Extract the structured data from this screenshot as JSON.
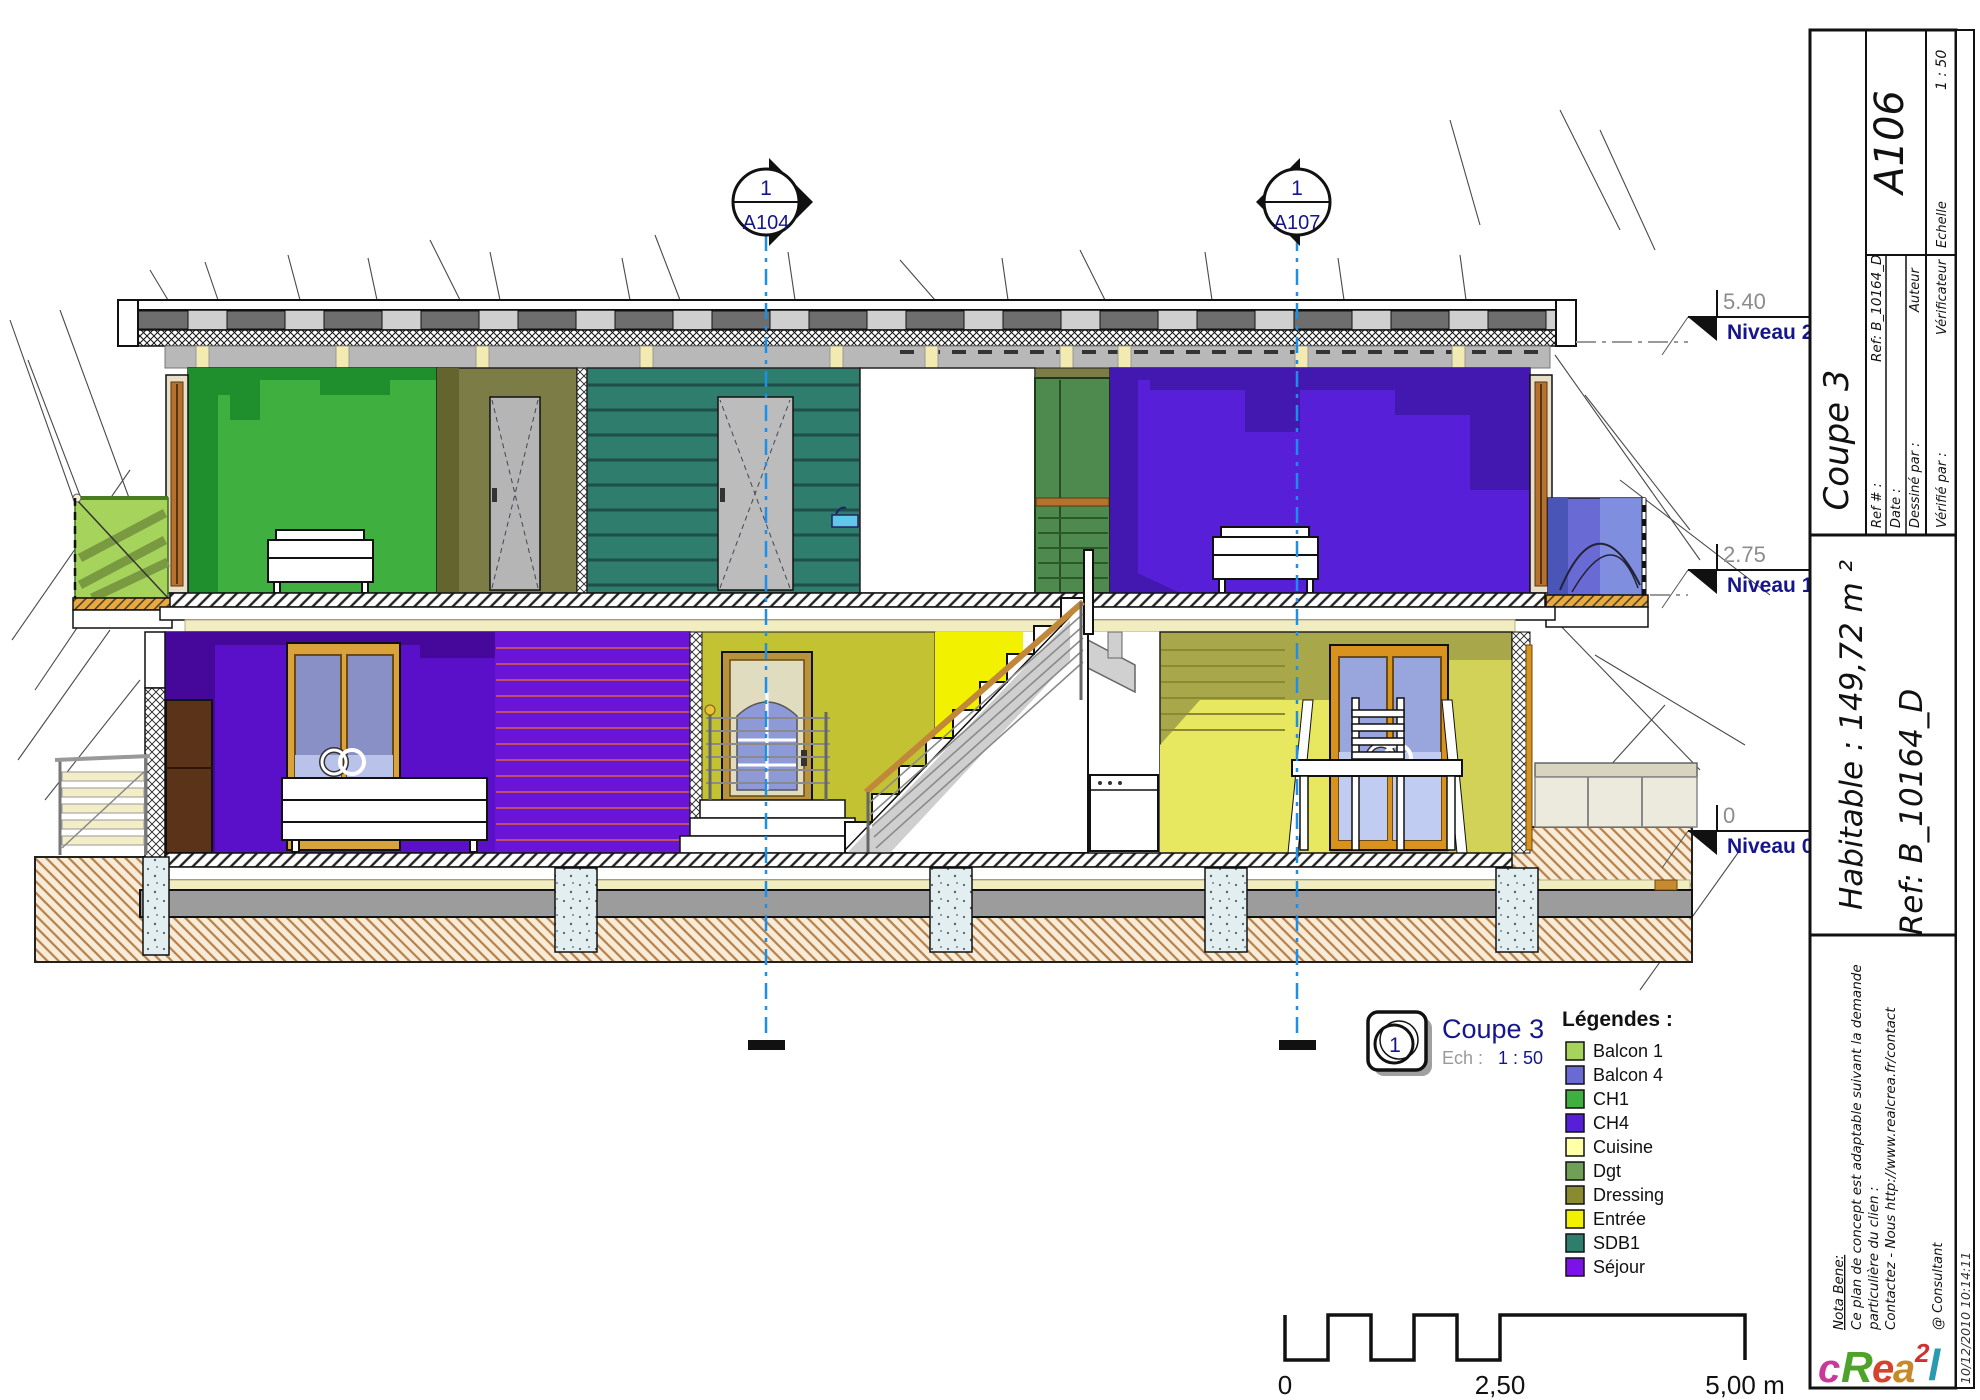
{
  "drawing": {
    "section_markers": [
      {
        "number": "1",
        "sheet": "A104"
      },
      {
        "number": "1",
        "sheet": "A107"
      }
    ],
    "levels": [
      {
        "elevation": "5.40",
        "name": "Niveau 2"
      },
      {
        "elevation": "2.75",
        "name": "Niveau 1"
      },
      {
        "elevation": "0",
        "name": "Niveau 0"
      }
    ],
    "view_label": {
      "number": "1",
      "title": "Coupe 3",
      "scale_prefix": "Ech :",
      "scale": "1 : 50"
    },
    "legend": {
      "title": "Légendes :",
      "items": [
        {
          "label": "Balcon 1",
          "color": "#a6d35c"
        },
        {
          "label": "Balcon 4",
          "color": "#6a6ad4"
        },
        {
          "label": "CH1",
          "color": "#3fb03f"
        },
        {
          "label": "CH4",
          "color": "#571fd8"
        },
        {
          "label": "Cuisine",
          "color": "#ffffa8"
        },
        {
          "label": "Dgt",
          "color": "#70a055"
        },
        {
          "label": "Dressing",
          "color": "#8a8a30"
        },
        {
          "label": "Entrée",
          "color": "#f2f200"
        },
        {
          "label": "SDB1",
          "color": "#2f7d6d"
        },
        {
          "label": "Séjour",
          "color": "#7d12e8"
        }
      ]
    },
    "scale_bar": {
      "start": "0",
      "middle": "2,50",
      "end": "5,00 m"
    }
  },
  "title_block": {
    "view_title": "Coupe 3",
    "sheet_number": "A106",
    "fields": {
      "ref_label": "Ref # :",
      "ref_value": "Ref: B_10164_D",
      "date_label": "Date :",
      "drawn_label": "Dessiné par :",
      "drawn_value": "Auteur",
      "checked_label": "Vérifié par :",
      "checked_value": "Vérificateur",
      "scale_label": "Echelle",
      "scale_value": "1 : 50"
    },
    "area": "Habitable : 149,72 m ²",
    "reference": "Ref: B_10164_D",
    "nota_bene": {
      "line1": "Nota Bene:",
      "line2": "Ce plan de concept est adaptable suivant la demande",
      "line3": "particulière du clien :",
      "line4": "Contactez - Nous http://www.realcrea.fr/contact"
    },
    "consultant": "@ Consultant",
    "timestamp": "10/12/2010 10:14:11",
    "logo": {
      "letters": [
        {
          "ch": "c",
          "color": "#c8399a"
        },
        {
          "ch": "R",
          "color": "#4fa32b"
        },
        {
          "ch": "e",
          "color": "#d8422c"
        },
        {
          "ch": "a",
          "color": "#c78a28"
        },
        {
          "ch": "2",
          "color": "#d03030"
        },
        {
          "ch": "l",
          "color": "#2a9ab0"
        }
      ]
    }
  }
}
